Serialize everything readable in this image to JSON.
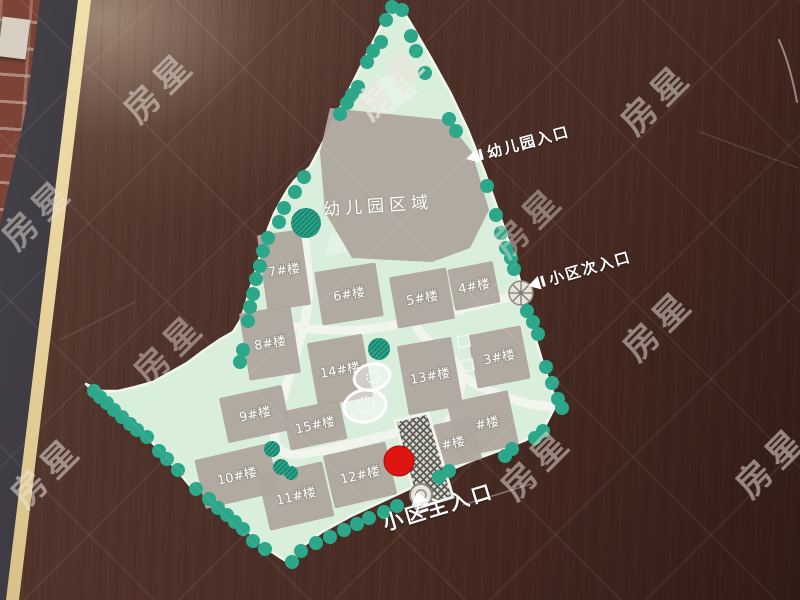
{
  "board": {
    "surface_color": "#4e3129",
    "frame_color": "#2b282c",
    "edge_stripe_color": "#e9d7a2",
    "brick_wall_color": "#7c4336"
  },
  "map": {
    "land_color": "#daeedc",
    "road_color": "#f2f4ee",
    "building_color": "#afa79e",
    "tree_color": "#2ca78a",
    "kindergarten_area_label": "幼儿园区域",
    "marker": {
      "x": 399,
      "y": 461,
      "r": 15,
      "color": "#df1512"
    },
    "entrances": {
      "kindergarten": {
        "label": "幼儿园入口"
      },
      "secondary": {
        "label": "小区次入口"
      },
      "main": {
        "label": "小区主入口"
      }
    },
    "buildings": [
      {
        "label": "7#楼",
        "x": 284,
        "y": 270,
        "w": 44,
        "h": 76,
        "rot": -8
      },
      {
        "label": "6#楼",
        "x": 349,
        "y": 294,
        "w": 62,
        "h": 54,
        "rot": -9
      },
      {
        "label": "5#楼",
        "x": 422,
        "y": 298,
        "w": 58,
        "h": 52,
        "rot": -10
      },
      {
        "label": "4#楼",
        "x": 474,
        "y": 286,
        "w": 46,
        "h": 42,
        "rot": -11
      },
      {
        "label": "8#楼",
        "x": 270,
        "y": 343,
        "w": 52,
        "h": 68,
        "rot": -9
      },
      {
        "label": "14#楼",
        "x": 340,
        "y": 370,
        "w": 56,
        "h": 64,
        "rot": -10
      },
      {
        "label": "13#楼",
        "x": 430,
        "y": 376,
        "w": 55,
        "h": 70,
        "rot": -10
      },
      {
        "label": "3#楼",
        "x": 499,
        "y": 357,
        "w": 54,
        "h": 54,
        "rot": -11
      },
      {
        "label": "9#楼",
        "x": 255,
        "y": 414,
        "w": 64,
        "h": 46,
        "rot": -12
      },
      {
        "label": "15#楼",
        "x": 315,
        "y": 425,
        "w": 58,
        "h": 40,
        "rot": -12
      },
      {
        "label": "2#楼",
        "x": 483,
        "y": 424,
        "w": 62,
        "h": 56,
        "rot": -12
      },
      {
        "label": "10#楼",
        "x": 237,
        "y": 476,
        "w": 76,
        "h": 50,
        "rot": -13
      },
      {
        "label": "12#楼",
        "x": 360,
        "y": 475,
        "w": 64,
        "h": 54,
        "rot": -13
      },
      {
        "label": "1#楼",
        "x": 449,
        "y": 444,
        "w": 58,
        "h": 44,
        "rot": -13
      },
      {
        "label": "11#楼",
        "x": 296,
        "y": 496,
        "w": 66,
        "h": 56,
        "rot": -13
      }
    ],
    "trees": [
      [
        392,
        7
      ],
      [
        402,
        10
      ],
      [
        411,
        36
      ],
      [
        416,
        51
      ],
      [
        425,
        73
      ],
      [
        449,
        119
      ],
      [
        456,
        131
      ],
      [
        487,
        186
      ],
      [
        496,
        215
      ],
      [
        501,
        233
      ],
      [
        506,
        248
      ],
      [
        511,
        258
      ],
      [
        514,
        269
      ],
      [
        527,
        311
      ],
      [
        533,
        322
      ],
      [
        538,
        334
      ],
      [
        546,
        367
      ],
      [
        552,
        383
      ],
      [
        558,
        399
      ],
      [
        562,
        408
      ],
      [
        543,
        431
      ],
      [
        535,
        438
      ],
      [
        512,
        449
      ],
      [
        505,
        456
      ],
      [
        449,
        471
      ],
      [
        439,
        477
      ],
      [
        397,
        506
      ],
      [
        384,
        512
      ],
      [
        369,
        518
      ],
      [
        357,
        524
      ],
      [
        344,
        530
      ],
      [
        330,
        537
      ],
      [
        316,
        543
      ],
      [
        301,
        551
      ],
      [
        292,
        562
      ],
      [
        265,
        549
      ],
      [
        253,
        541
      ],
      [
        243,
        529
      ],
      [
        235,
        522
      ],
      [
        227,
        515
      ],
      [
        218,
        508
      ],
      [
        209,
        499
      ],
      [
        196,
        489
      ],
      [
        178,
        470
      ],
      [
        167,
        459
      ],
      [
        159,
        451
      ],
      [
        147,
        437
      ],
      [
        137,
        430
      ],
      [
        130,
        424
      ],
      [
        122,
        417
      ],
      [
        114,
        410
      ],
      [
        107,
        403
      ],
      [
        100,
        397
      ],
      [
        94,
        391
      ],
      [
        304,
        177
      ],
      [
        295,
        192
      ],
      [
        284,
        208
      ],
      [
        279,
        222
      ],
      [
        268,
        238
      ],
      [
        263,
        251
      ],
      [
        260,
        266
      ],
      [
        256,
        279
      ],
      [
        253,
        294
      ],
      [
        250,
        307
      ],
      [
        248,
        321
      ],
      [
        243,
        350
      ],
      [
        240,
        362
      ],
      [
        340,
        114
      ],
      [
        347,
        103
      ],
      [
        352,
        95
      ],
      [
        358,
        87
      ],
      [
        367,
        62
      ],
      [
        373,
        51
      ],
      [
        381,
        42
      ],
      [
        386,
        20
      ],
      [
        306,
        223,
        15,
        "h"
      ],
      [
        379,
        349,
        11,
        "h"
      ],
      [
        272,
        449,
        8,
        "h"
      ],
      [
        281,
        467,
        8,
        "h"
      ],
      [
        291,
        473,
        7,
        "h"
      ]
    ]
  },
  "watermark": {
    "text": "房星",
    "items": [
      [
        390,
        82,
        0.75
      ],
      [
        158,
        85,
        0.5
      ],
      [
        655,
        97,
        0.5
      ],
      [
        36,
        212,
        0.48
      ],
      [
        527,
        220,
        0.42
      ],
      [
        657,
        323,
        0.5
      ],
      [
        168,
        347,
        0.45
      ],
      [
        45,
        470,
        0.52
      ],
      [
        535,
        462,
        0.5
      ],
      [
        770,
        460,
        0.52
      ]
    ]
  }
}
